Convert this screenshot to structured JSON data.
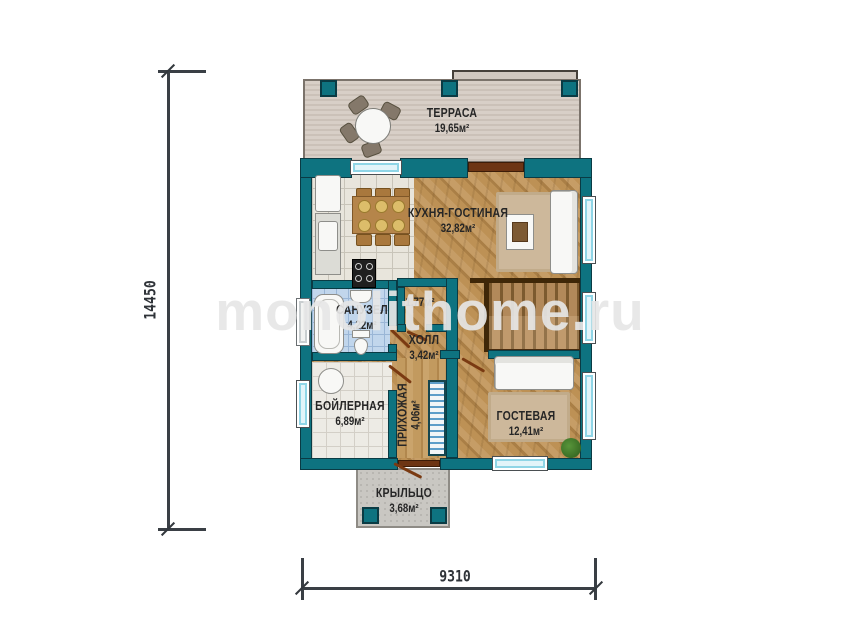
{
  "watermark": {
    "text": "monolithome.ru"
  },
  "dimensions": {
    "vertical": "14450",
    "horizontal": "9310"
  },
  "rooms": {
    "terrace": {
      "name": "ТЕРРАСА",
      "area": "19,65м²"
    },
    "kitchen_living": {
      "name": "КУХНЯ-ГОСТИНАЯ",
      "area": "32,82м²"
    },
    "bathroom": {
      "name": "САНУЗЕЛ",
      "area": "4,22м²"
    },
    "wardrobe": {
      "area": "1,77м²"
    },
    "hall": {
      "name": "ХОЛЛ",
      "area": "3,42м²"
    },
    "boiler_room": {
      "name": "БОЙЛЕРНАЯ",
      "area": "6,89м²"
    },
    "entry_hall": {
      "name": "ПРИХОЖАЯ",
      "area": "4,06м²"
    },
    "guest_room": {
      "name": "ГОСТЕВАЯ",
      "area": "12,41м²"
    },
    "porch": {
      "name": "КРЫЛЬЦО",
      "area": "3,68м²"
    }
  },
  "colors": {
    "wall_teal": "#0e7380",
    "wood_floor": "#b78e58",
    "terrace_deck": "#d6cdc5",
    "bathroom_tile": "#c1d6ec",
    "window_glass": "#8fd5e6",
    "door_wood": "#7a3a12",
    "dimension_line": "#3a3f45"
  }
}
